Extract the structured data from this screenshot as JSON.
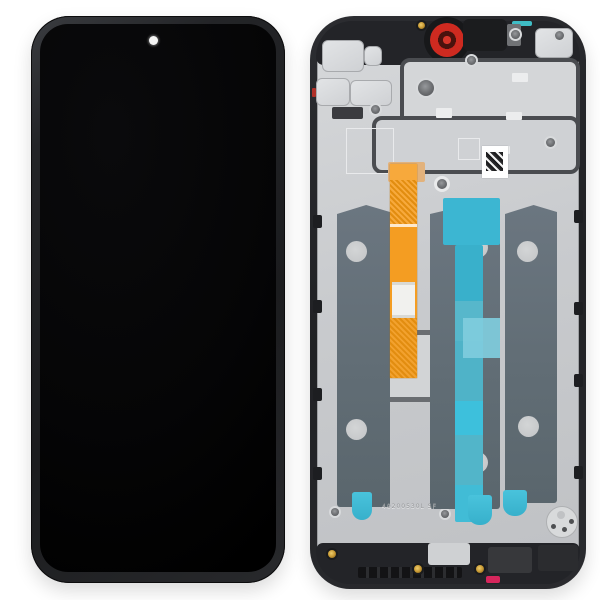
{
  "photo": {
    "subject": "Phone LCD screen digitizer full assembly with middle frame, front view and rear view",
    "background_color": "#ffffff"
  },
  "front_assembly": {
    "name": "LCD screen front view",
    "screen_color": "#060608",
    "frame_color": "#26272a",
    "punch_hole_camera_color": "#f4f4f4"
  },
  "rear_frame": {
    "name": "middle frame rear view",
    "engraving": "40200530L SF",
    "colors": {
      "chassis_plastic": "#232428",
      "metal_plate": "#cbcdd0",
      "lcd_back_panel": "#63707a",
      "adhesive_film_cyan": "#3cb6d2",
      "adhesive_film_pale": "#7fccdd",
      "flex_cable_orange": "#f49d22",
      "camera_ring_red": "#ce2a20",
      "gold_screw": "#c89a34",
      "seal_sticker_red": "#d6265c",
      "qr_label": "#ffffff"
    }
  }
}
